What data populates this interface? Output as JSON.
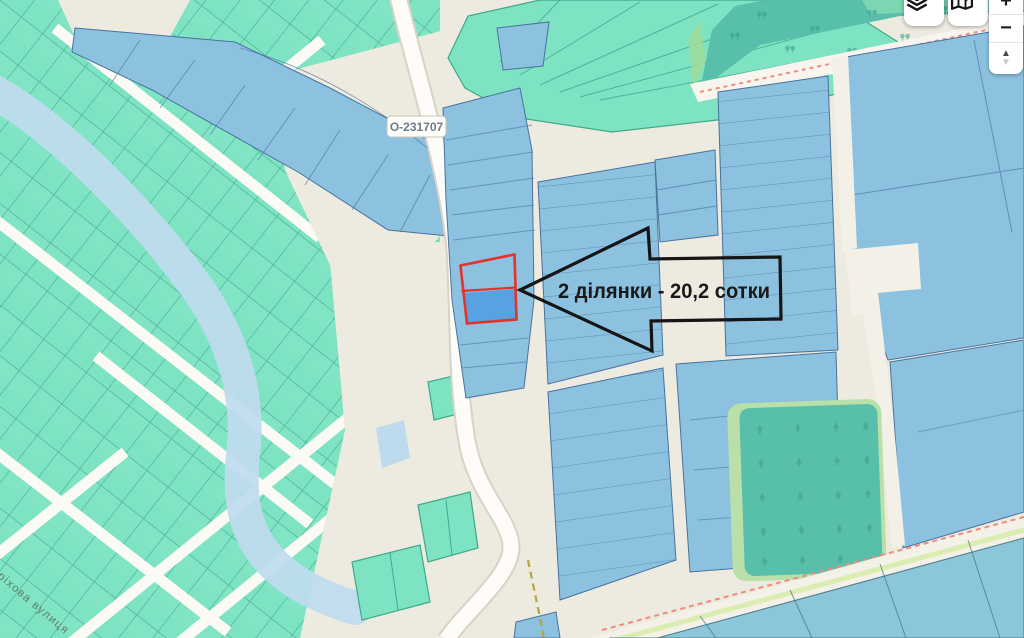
{
  "map": {
    "annotation_label": "2 ділянки - 20,2 сотки",
    "road_ref": "О-231707",
    "street_name": "Горіхова вулиця",
    "colors": {
      "background": "#edebe0",
      "parcel_teal": "#7ee3c3",
      "parcel_blue": "#8dc1e0",
      "selected_parcel_blue": "#58a1e2",
      "highlight_red": "#e53128",
      "forest_teal": "#58bfab",
      "forest_edge_green": "#b9e0a8",
      "river_blue": "#bedbee",
      "road_white": "#fdfcf9",
      "boundary_red_dash": "#ef8b80",
      "boundary_olive_dash": "#b5a53a",
      "annotation_black": "#151515"
    }
  },
  "controls": {
    "layers_icon": "layers-icon",
    "locate_icon": "map-location-icon",
    "zoom_in": "+",
    "zoom_out": "−",
    "tilt_up": "▲",
    "tilt_down": "▼"
  }
}
